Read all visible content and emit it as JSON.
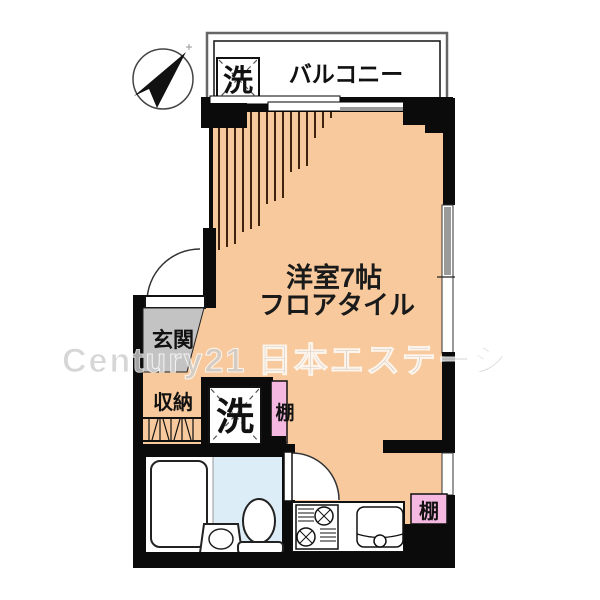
{
  "watermark": "Century21 日本エステージ",
  "colors": {
    "floor": "#f7c99c",
    "entrance": "#c3c3c3",
    "shelf": "#f5b9e1",
    "bath": "#dcedf8",
    "wall": "#0b0b0b",
    "fringe": "#40240e",
    "watermark_gray": "#cccccc",
    "window_shade": "#9b9b9b"
  },
  "labels": {
    "balcony": "バルコニー",
    "balcony_washer": "洗",
    "room_name": "洋室7帖",
    "room_floor": "フロアタイル",
    "entrance": "玄関",
    "storage": "収納",
    "washer": "洗",
    "shelf_mid": "棚",
    "shelf_kitchen": "棚"
  }
}
